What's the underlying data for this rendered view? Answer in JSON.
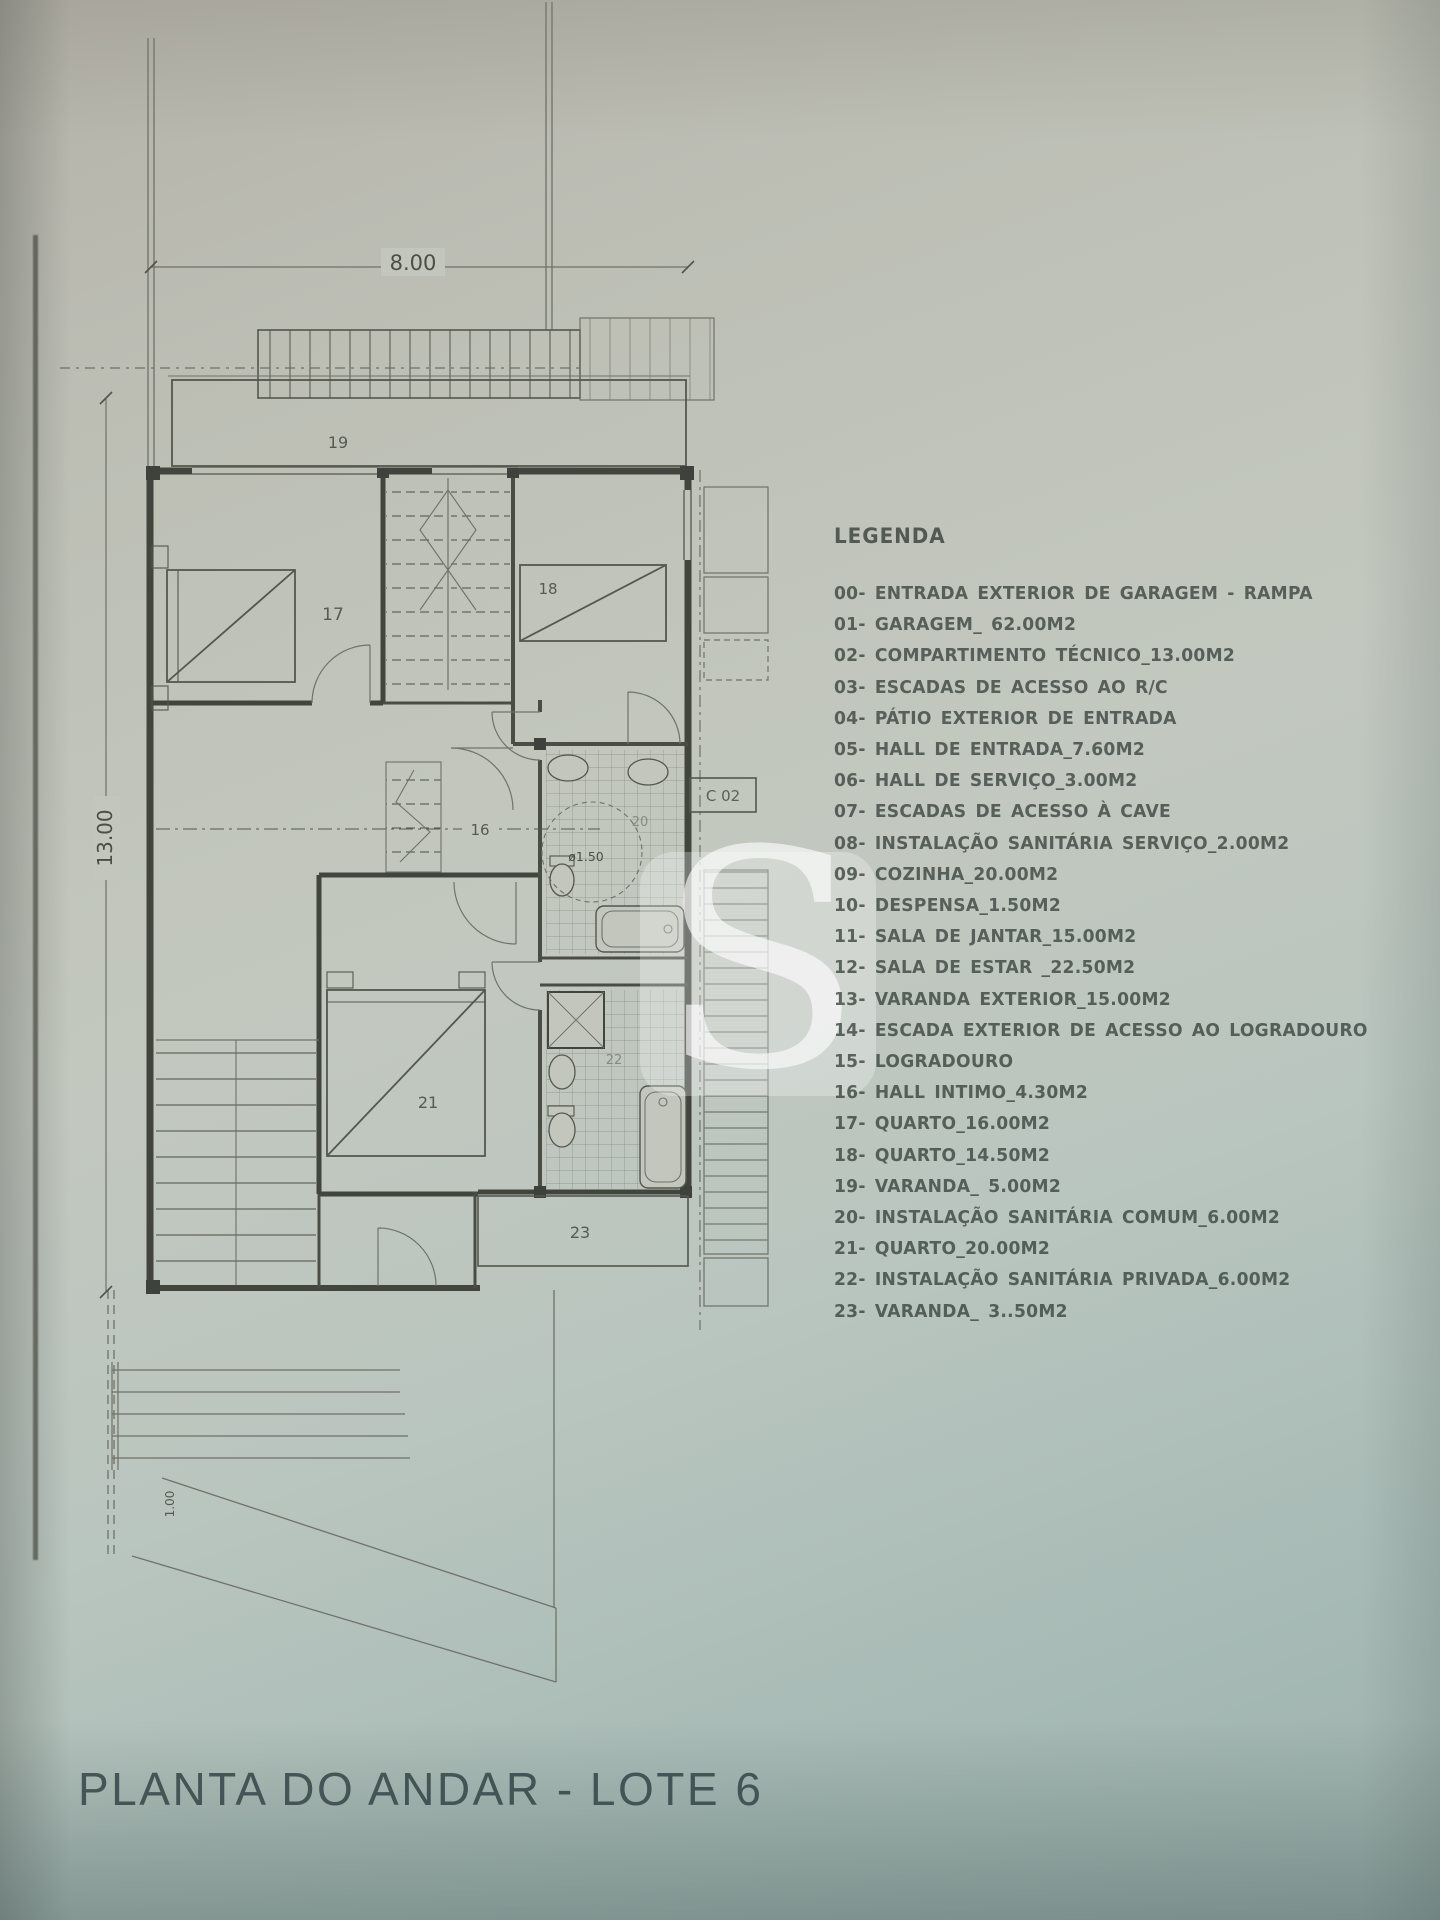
{
  "photo": {
    "paper_top_color": "#b5b3aa",
    "paper_mid_color": "#c3c8bf",
    "paper_bottom_color": "#9db1ad",
    "ink_color": "#4b4e46",
    "title_color": "#3c4a4d"
  },
  "watermark": {
    "letter": "S"
  },
  "plan": {
    "labels": {
      "dim_width": "8.00",
      "dim_depth": "13.00",
      "dim_entry": "1.00",
      "room_19": "19",
      "room_17": "17",
      "room_18": "18",
      "room_16": "16",
      "room_20": "20",
      "room_21": "21",
      "room_22": "22",
      "room_23": "23",
      "annex": "C 02",
      "shower_diameter": "ø1.50"
    }
  },
  "legend": {
    "title": "LEGENDA",
    "items": [
      "00- ENTRADA EXTERIOR DE GARAGEM - RAMPA",
      "01- GARAGEM_ 62.00M2",
      "02- COMPARTIMENTO TÉCNICO_13.00M2",
      "03- ESCADAS DE ACESSO AO R/C",
      "04- PÁTIO EXTERIOR DE ENTRADA",
      "05- HALL DE ENTRADA_7.60M2",
      "06- HALL DE SERVIÇO_3.00M2",
      "07- ESCADAS DE ACESSO À CAVE",
      "08- INSTALAÇÃO SANITÁRIA SERVIÇO_2.00M2",
      "09- COZINHA_20.00M2",
      "10- DESPENSA_1.50M2",
      "11- SALA DE JANTAR_15.00M2",
      "12- SALA DE ESTAR _22.50M2",
      "13- VARANDA EXTERIOR_15.00M2",
      "14- ESCADA EXTERIOR DE ACESSO AO LOGRADOURO",
      "15- LOGRADOURO",
      "16- HALL INTIMO_4.30M2",
      "17- QUARTO_16.00M2",
      "18- QUARTO_14.50M2",
      "19- VARANDA_ 5.00M2",
      "20- INSTALAÇÃO SANITÁRIA COMUM_6.00M2",
      "21- QUARTO_20.00M2",
      "22- INSTALAÇÃO SANITÁRIA PRIVADA_6.00M2",
      "23- VARANDA_ 3..50M2"
    ]
  },
  "footer": {
    "title": "PLANTA DO ANDAR - LOTE 6"
  }
}
